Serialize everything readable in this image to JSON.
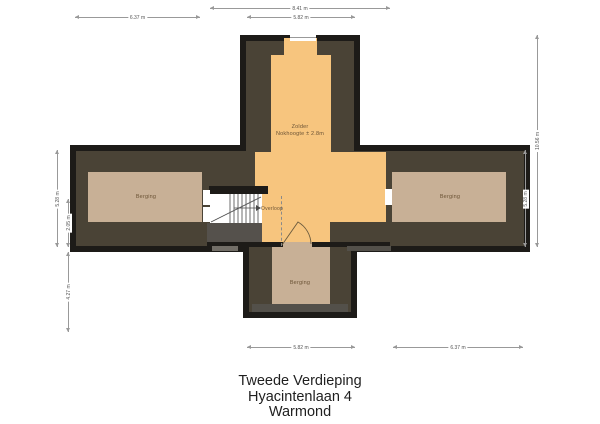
{
  "floorplan": {
    "rooms": {
      "zolder": {
        "label": "Zolder",
        "note": "Nokhoogte ± 2.8m"
      },
      "berging_left": {
        "label": "Berging"
      },
      "berging_right": {
        "label": "Berging"
      },
      "berging_bottom": {
        "label": "Berging"
      },
      "overloop": {
        "label": "Overloop"
      }
    },
    "dimensions": {
      "top_total": "8.41 m",
      "top_center": "5.82 m",
      "top_left": "6.37 m",
      "left_outer": "5.28 m",
      "left_inner_upper": "2.05 m",
      "left_inner_lower": "4.27 m",
      "right_outer": "10.56 m",
      "right_inner": "5.28 m",
      "bottom_center": "5.82 m",
      "bottom_right": "6.37 m"
    },
    "colors": {
      "wall": "#1d1b18",
      "roof_fill": "#4a4336",
      "floor_orange": "#f7c57e",
      "room_tan": "#c8b096",
      "under_stairs_gray": "#55514c",
      "dimension_line": "#999999"
    }
  },
  "title_block": {
    "line1": "Tweede Verdieping",
    "line2": "Hyacintenlaan 4",
    "line3": "Warmond"
  }
}
